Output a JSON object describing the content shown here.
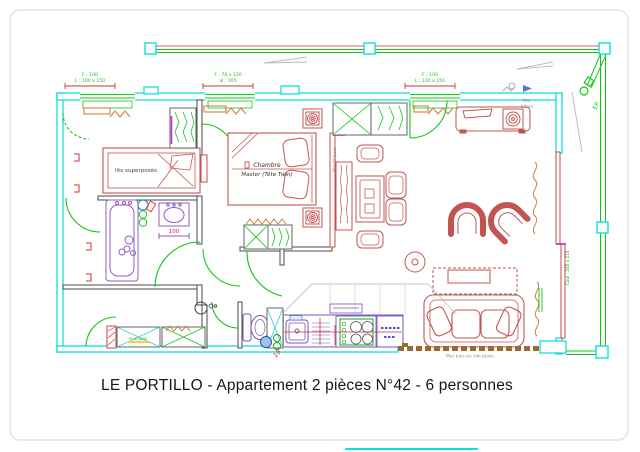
{
  "title": "LE PORTILLO - Appartement 2 pièces N°42 - 6 personnes",
  "labels": {
    "bunk_room": "lits superposés",
    "bedroom_line1": "Chambre",
    "bedroom_line2": "Master (Tête Twin)",
    "closet": "PLACARD",
    "washbasin_dim": "100",
    "washer_dim": "18",
    "mur_beton_line1": "Mur",
    "mur_beton_line2": "béton",
    "mur_briques": "Mur briques",
    "mur_bois": "Mur bois en clin blanc",
    "downspout": "EP",
    "sliding_door": "Coul : 240 x 215",
    "window_left_line1": "F : 100",
    "window_left_line2": "L : 100 x 150",
    "window_middle_line1": "F : 70 x 120",
    "window_middle_line2": "al : 105",
    "window_right_line1": "F : 100",
    "window_right_line2": "L : 100 x 150"
  },
  "colors": {
    "wall": "#10dede",
    "fixture_green": "#17c517",
    "furniture_red": "#c25552",
    "sanitary_purple": "#8f5fc2",
    "kitchen_purple": "#7755bb",
    "radiator_orange": "#cd7733",
    "dimension_red": "#cc3333",
    "wood_wall_brown": "#9a6a32",
    "annotation_gray": "#8a8a8a",
    "magenta": "#cc33cc"
  }
}
